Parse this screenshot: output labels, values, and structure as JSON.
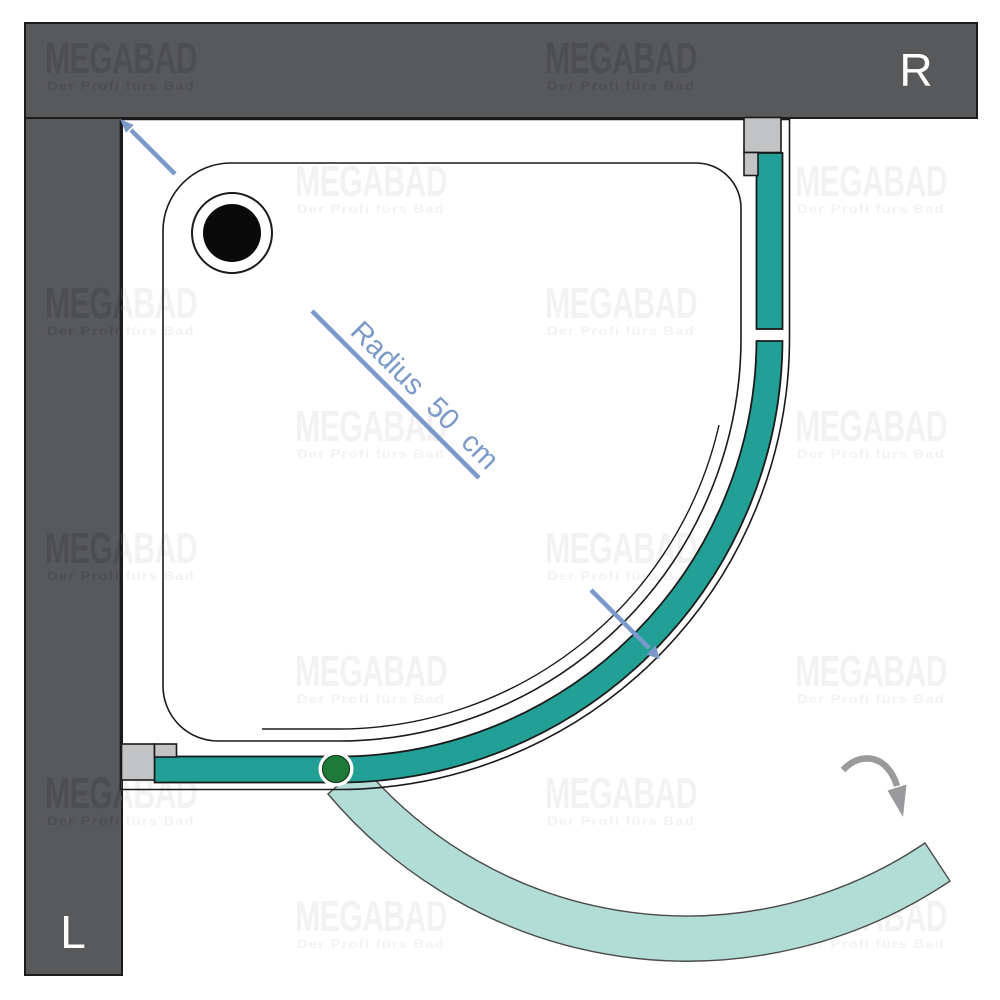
{
  "brand": {
    "logo": "MEGABAD",
    "tagline": "Der Profi fürs Bad"
  },
  "walls": {
    "right_label": "R",
    "left_label": "L"
  },
  "dimension": {
    "radius_label": "Radius 50 cm"
  },
  "colors": {
    "glass_teal": "#22a096",
    "glass_swing_pale": "#b2dcd6",
    "wall_gray": "#58595b",
    "wall_watermark": "#4d4e50",
    "white_watermark": "#f2f2f2",
    "dimension_blue": "#7b9aca",
    "swing_arrow_gray": "#9a9a9c",
    "pivot_green": "#1e7a38",
    "bracket_gray": "#c2c3c4"
  }
}
